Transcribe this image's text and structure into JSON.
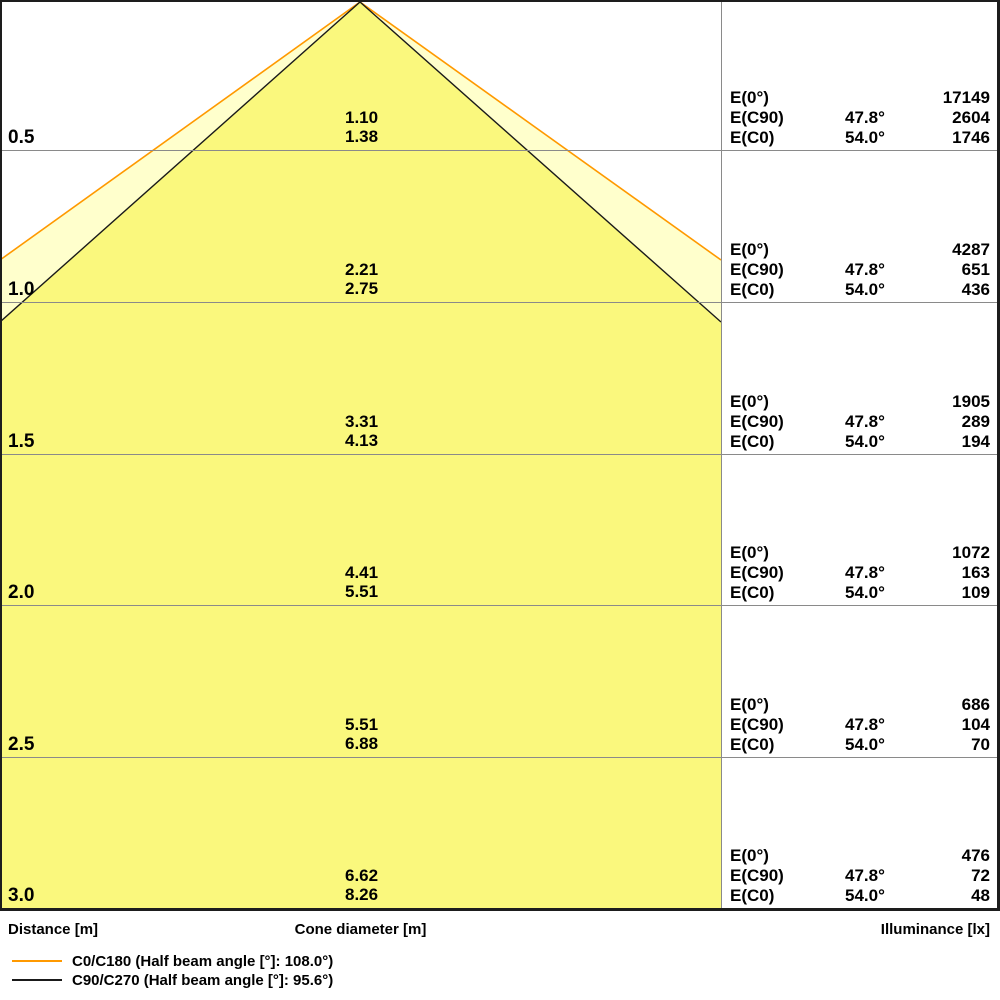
{
  "axis": {
    "distance_label": "Distance [m]",
    "cone_label": "Cone diameter [m]",
    "illuminance_label": "Illuminance [lx]"
  },
  "table": {
    "e0_label": "E(0°)",
    "ec90_label": "E(C90)",
    "ec0_label": "E(C0)",
    "rows": [
      {
        "distance": "0.5",
        "cone_c90": "1.10",
        "cone_c0": "1.38",
        "e0": "17149",
        "ec90_angle": "47.8°",
        "ec90": "2604",
        "ec0_angle": "54.0°",
        "ec0": "1746"
      },
      {
        "distance": "1.0",
        "cone_c90": "2.21",
        "cone_c0": "2.75",
        "e0": "4287",
        "ec90_angle": "47.8°",
        "ec90": "651",
        "ec0_angle": "54.0°",
        "ec0": "436"
      },
      {
        "distance": "1.5",
        "cone_c90": "3.31",
        "cone_c0": "4.13",
        "e0": "1905",
        "ec90_angle": "47.8°",
        "ec90": "289",
        "ec0_angle": "54.0°",
        "ec0": "194"
      },
      {
        "distance": "2.0",
        "cone_c90": "4.41",
        "cone_c0": "5.51",
        "e0": "1072",
        "ec90_angle": "47.8°",
        "ec90": "163",
        "ec0_angle": "54.0°",
        "ec0": "109"
      },
      {
        "distance": "2.5",
        "cone_c90": "5.51",
        "cone_c0": "6.88",
        "e0": "686",
        "ec90_angle": "47.8°",
        "ec90": "104",
        "ec0_angle": "54.0°",
        "ec0": "70"
      },
      {
        "distance": "3.0",
        "cone_c90": "6.62",
        "cone_c0": "8.26",
        "e0": "476",
        "ec90_angle": "47.8°",
        "ec90": "72",
        "ec0_angle": "54.0°",
        "ec0": "48"
      }
    ]
  },
  "legend": [
    {
      "label": "C0/C180 (Half beam angle [°]: 108.0°)",
      "color": "#FF9900"
    },
    {
      "label": "C90/C270 (Half beam angle [°]: 95.6°)",
      "color": "#1A1A1A"
    }
  ],
  "colors": {
    "inner_cone_fill": "#FAF87D",
    "outer_cone_fill": "#FFFFCC",
    "c0_line": "#FF9900",
    "c90_line": "#1A1A1A",
    "grid": "#8A8A8A"
  },
  "chart_data": {
    "type": "area",
    "title": "Light cone diagram with illuminance table",
    "xlabel": "Distance [m]",
    "ylabel_center": "Cone diameter [m]",
    "ylabel_right": "Illuminance [lx]",
    "distances_m": [
      0.5,
      1.0,
      1.5,
      2.0,
      2.5,
      3.0
    ],
    "series": [
      {
        "name": "C0/C180 (Half beam angle [°]: 108.0°)",
        "half_beam_angle_deg": 108.0,
        "edge_angle_deg": 54.0,
        "cone_diameter_m": [
          1.38,
          2.75,
          4.13,
          5.51,
          6.88,
          8.26
        ],
        "color": "#FF9900"
      },
      {
        "name": "C90/C270 (Half beam angle [°]: 95.6°)",
        "half_beam_angle_deg": 95.6,
        "edge_angle_deg": 47.8,
        "cone_diameter_m": [
          1.1,
          2.21,
          3.31,
          4.41,
          5.51,
          6.62
        ],
        "color": "#1A1A1A"
      }
    ],
    "illuminance_lx": [
      {
        "metric": "E(0°)",
        "angle_deg": null,
        "values": [
          17149,
          4287,
          1905,
          1072,
          686,
          476
        ]
      },
      {
        "metric": "E(C90)",
        "angle_deg": 47.8,
        "values": [
          2604,
          651,
          289,
          163,
          104,
          72
        ]
      },
      {
        "metric": "E(C0)",
        "angle_deg": 54.0,
        "values": [
          1746,
          436,
          194,
          109,
          70,
          48
        ]
      }
    ],
    "legend_position": "bottom-left",
    "grid": true
  }
}
